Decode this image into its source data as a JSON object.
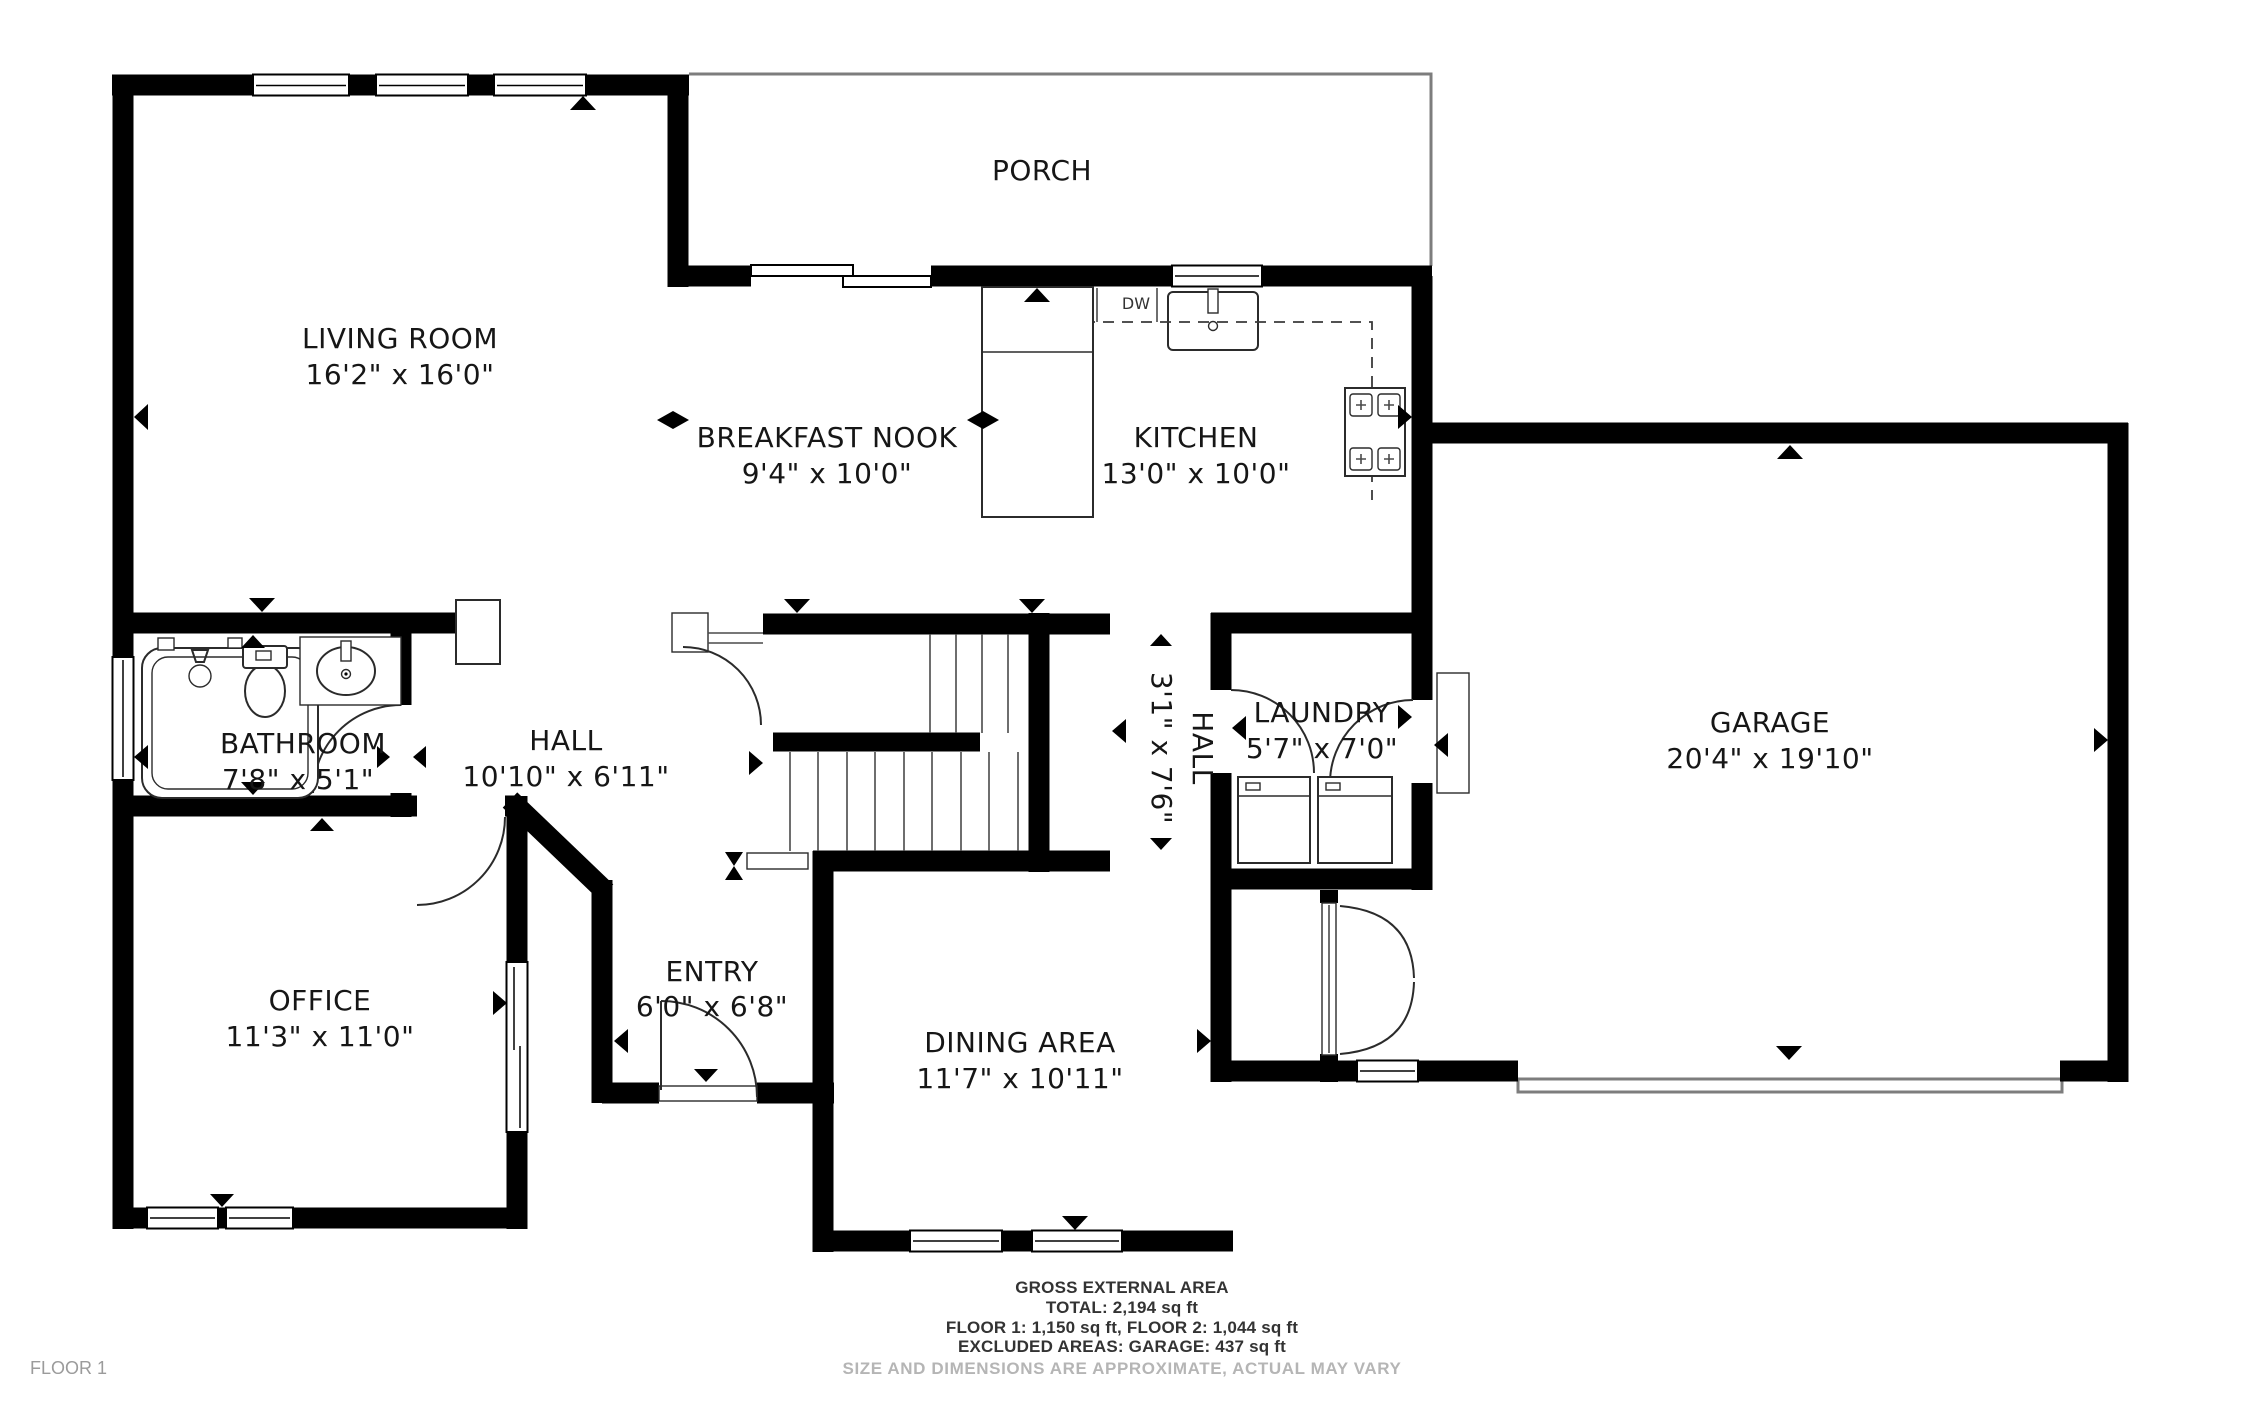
{
  "floor_plan": {
    "rooms": {
      "porch": {
        "name": "PORCH",
        "dims": ""
      },
      "living_room": {
        "name": "LIVING ROOM",
        "dims": "16'2\" x 16'0\""
      },
      "breakfast_nook": {
        "name": "BREAKFAST NOOK",
        "dims": "9'4\" x 10'0\""
      },
      "kitchen": {
        "name": "KITCHEN",
        "dims": "13'0\" x 10'0\""
      },
      "garage": {
        "name": "GARAGE",
        "dims": "20'4\" x 19'10\""
      },
      "bathroom": {
        "name": "BATHROOM",
        "dims": "7'8\" x 5'1\""
      },
      "hall": {
        "name": "HALL",
        "dims": "10'10\" x 6'11\""
      },
      "hall_upper": {
        "name": "HALL",
        "dims": "3'1\" x 7'6\""
      },
      "laundry": {
        "name": "LAUNDRY",
        "dims": "5'7\" x 7'0\""
      },
      "office": {
        "name": "OFFICE",
        "dims": "11'3\" x 11'0\""
      },
      "entry": {
        "name": "ENTRY",
        "dims": "6'0\" x 6'8\""
      },
      "dining_area": {
        "name": "DINING AREA",
        "dims": "11'7\" x 10'11\""
      }
    },
    "appliances": {
      "dishwasher": "DW"
    },
    "colors": {
      "wall": "#000000",
      "thin_outline": "#7d7d7d",
      "label": "#161616",
      "muted": "#b5b5b5"
    }
  },
  "footer": {
    "heading": "GROSS EXTERNAL AREA",
    "total": "TOTAL: 2,194 sq ft",
    "floors": "FLOOR 1: 1,150 sq ft, FLOOR 2: 1,044 sq ft",
    "excluded": "EXCLUDED AREAS: GARAGE: 437 sq ft",
    "disclaimer": "SIZE AND DIMENSIONS ARE APPROXIMATE, ACTUAL MAY VARY"
  },
  "floor_label": "FLOOR 1"
}
